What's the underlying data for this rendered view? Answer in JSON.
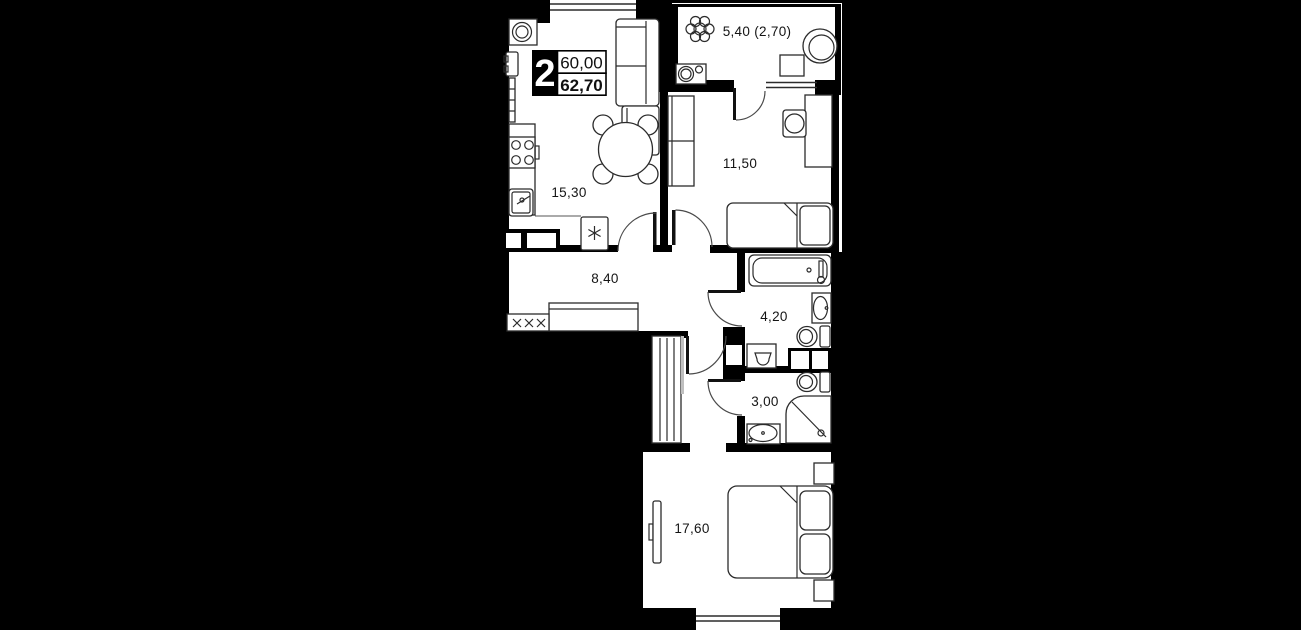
{
  "floorplan": {
    "badge": {
      "rooms": "2",
      "value_top": "60,00",
      "value_bottom": "62,70"
    },
    "rooms": {
      "kitchen_living": {
        "area": "15,30"
      },
      "balcony": {
        "area": "5,40 (2,70)"
      },
      "bedroom_1": {
        "area": "11,50"
      },
      "hallway": {
        "area": "8,40"
      },
      "bathroom": {
        "area": "4,20"
      },
      "toilet": {
        "area": "3,00"
      },
      "bedroom_2": {
        "area": "17,60"
      }
    },
    "colors": {
      "background": "#000000",
      "floor": "#ffffff",
      "walls": "#000000",
      "lines": "#2b2b2b"
    }
  }
}
